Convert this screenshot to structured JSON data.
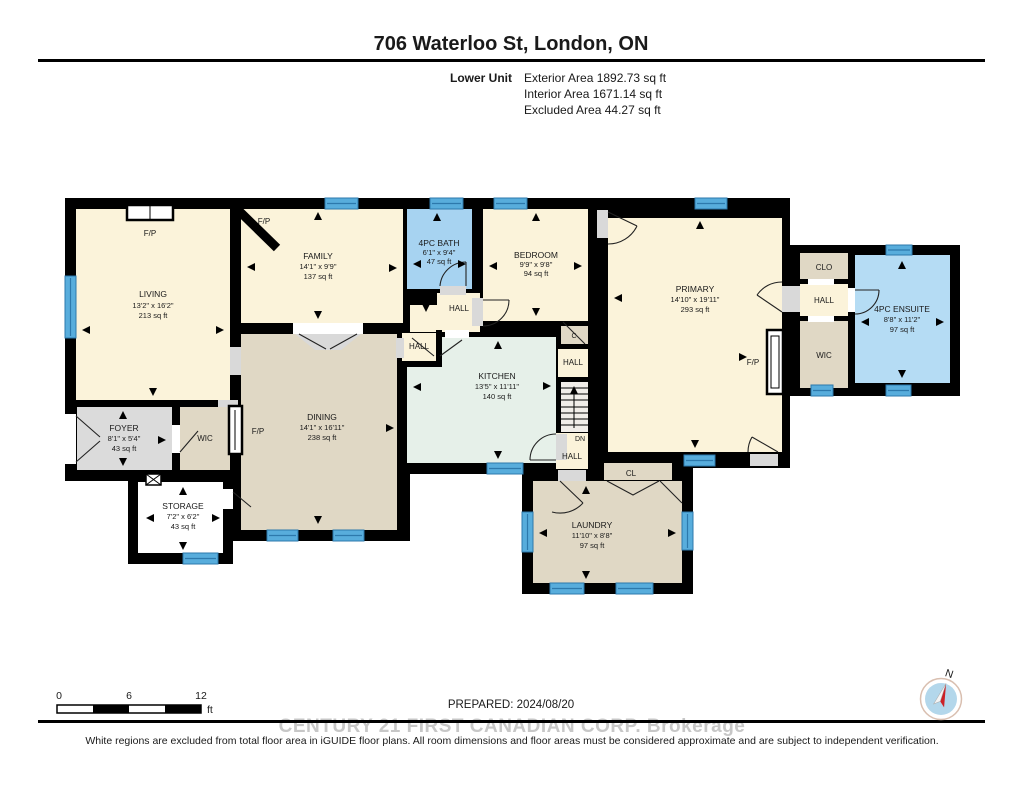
{
  "header": {
    "title": "706 Waterloo St, London, ON",
    "unit_label": "Lower Unit",
    "area_lines": [
      "Exterior Area 1892.73 sq ft",
      "Interior Area 1671.14 sq ft",
      "Excluded Area 44.27 sq ft"
    ]
  },
  "rooms": {
    "living": {
      "name": "LIVING",
      "dims": "13'2\" x 16'2\"",
      "area": "213 sq ft"
    },
    "family": {
      "name": "FAMILY",
      "dims": "14'1\" x 9'9\"",
      "area": "137 sq ft"
    },
    "bath": {
      "name": "4PC BATH",
      "dims": "6'1\" x 9'4\"",
      "area": "47 sq ft"
    },
    "bedroom": {
      "name": "BEDROOM",
      "dims": "9'9\" x 9'8\"",
      "area": "94 sq ft"
    },
    "primary": {
      "name": "PRIMARY",
      "dims": "14'10\" x 19'11\"",
      "area": "293 sq ft"
    },
    "ensuite": {
      "name": "4PC ENSUITE",
      "dims": "8'8\" x 11'2\"",
      "area": "97 sq ft"
    },
    "kitchen": {
      "name": "KITCHEN",
      "dims": "13'5\" x 11'11\"",
      "area": "140 sq ft"
    },
    "dining": {
      "name": "DINING",
      "dims": "14'1\" x 16'11\"",
      "area": "238 sq ft"
    },
    "foyer": {
      "name": "FOYER",
      "dims": "8'1\" x 5'4\"",
      "area": "43 sq ft"
    },
    "storage": {
      "name": "STORAGE",
      "dims": "7'2\" x 6'2\"",
      "area": "43 sq ft"
    },
    "laundry": {
      "name": "LAUNDRY",
      "dims": "11'10\" x 8'8\"",
      "area": "97 sq ft"
    }
  },
  "labels": {
    "fireplace": "F/P",
    "hall": "HALL",
    "wic": "WIC",
    "clo": "CLO",
    "cl": "CL",
    "c": "C",
    "down": "DN"
  },
  "scale_bar": {
    "ticks": [
      "0",
      "6",
      "12"
    ],
    "unit": "ft"
  },
  "footer": {
    "prepared": "PREPARED: 2024/08/20",
    "watermark": "CENTURY 21 FIRST CANADIAN CORP. Brokerage",
    "disclaimer": "White regions are excluded from total floor area in iGUIDE floor plans. All room dimensions and floor areas must be considered approximate and are subject to independent verification."
  },
  "compass": {
    "north": "N"
  },
  "colors": {
    "wall": "#000000",
    "room_cream": "#FBF3DA",
    "room_tan": "#E0D8C5",
    "room_kitchen": "#E6F0E9",
    "room_bath": "#A7D3F1",
    "room_ensuite": "#B5DCF4",
    "room_gray": "#DBDBDB",
    "excluded_white": "#FFFFFF",
    "window_blue": "#58ADDC",
    "compass_needle_red": "#CC2127",
    "watermark_gray": "#C7C7C7"
  }
}
